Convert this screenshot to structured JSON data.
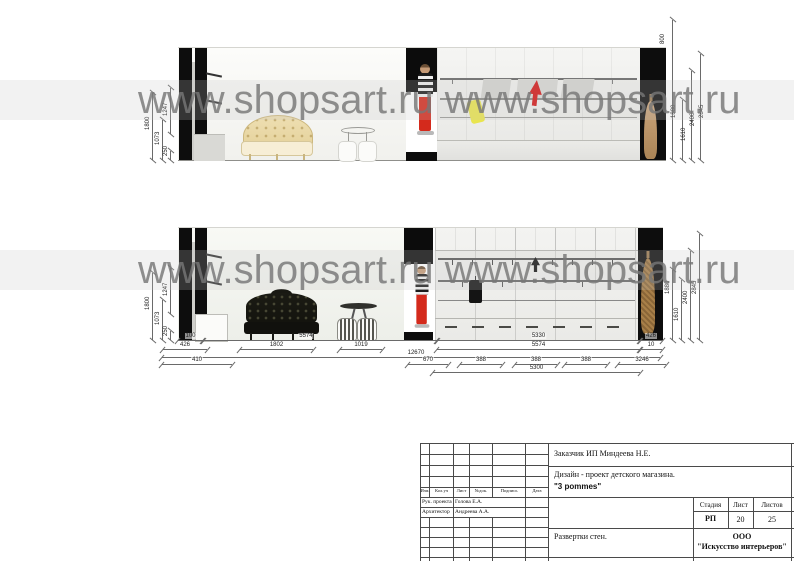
{
  "watermark": {
    "text": "www.shopsart.ru",
    "display": "www.shopsart.ru www.shopsart.ru"
  },
  "ev1": {
    "ldims": [
      "1800",
      "1073",
      "250",
      "1247"
    ],
    "rdims": [
      "800",
      "1880",
      "1610",
      "2400",
      "2845"
    ]
  },
  "ev2": {
    "ldims": [
      "1800",
      "1073",
      "250",
      "1247"
    ],
    "rdims": [
      "1880",
      "1610",
      "2400",
      "2845"
    ],
    "b1": [
      "100",
      "5574",
      "5330",
      "426"
    ],
    "b2": [
      "426",
      "1802",
      "1019",
      "5574",
      "10"
    ],
    "b3": [
      "12670"
    ],
    "b4": [
      "410",
      "670",
      "388",
      "388",
      "388",
      "3246"
    ],
    "b5": [
      "5300"
    ]
  },
  "titleblock": {
    "client": "Заказчик ИП Миндеева Н.Е.",
    "project_line": "Дизайн - проект детского магазина.",
    "brand": "\"3 pommes\"",
    "cols": [
      "Изм.",
      "Кол.уч",
      "Лист",
      "№док.",
      "Подпись",
      "Дата"
    ],
    "roles": [
      {
        "role": "Рук. проекта",
        "name": "Голова Е.А."
      },
      {
        "role": "Архитектор",
        "name": "Андреева А.А."
      }
    ],
    "stage_label": "Стадия",
    "sheet_label": "Лист",
    "sheets_label": "Листов",
    "stage": "РП",
    "sheet": "20",
    "sheets": "25",
    "sheet_title": "Развертки стен.",
    "company_line1": "ООО",
    "company_line2": "\"Искусство интерьеров\""
  }
}
